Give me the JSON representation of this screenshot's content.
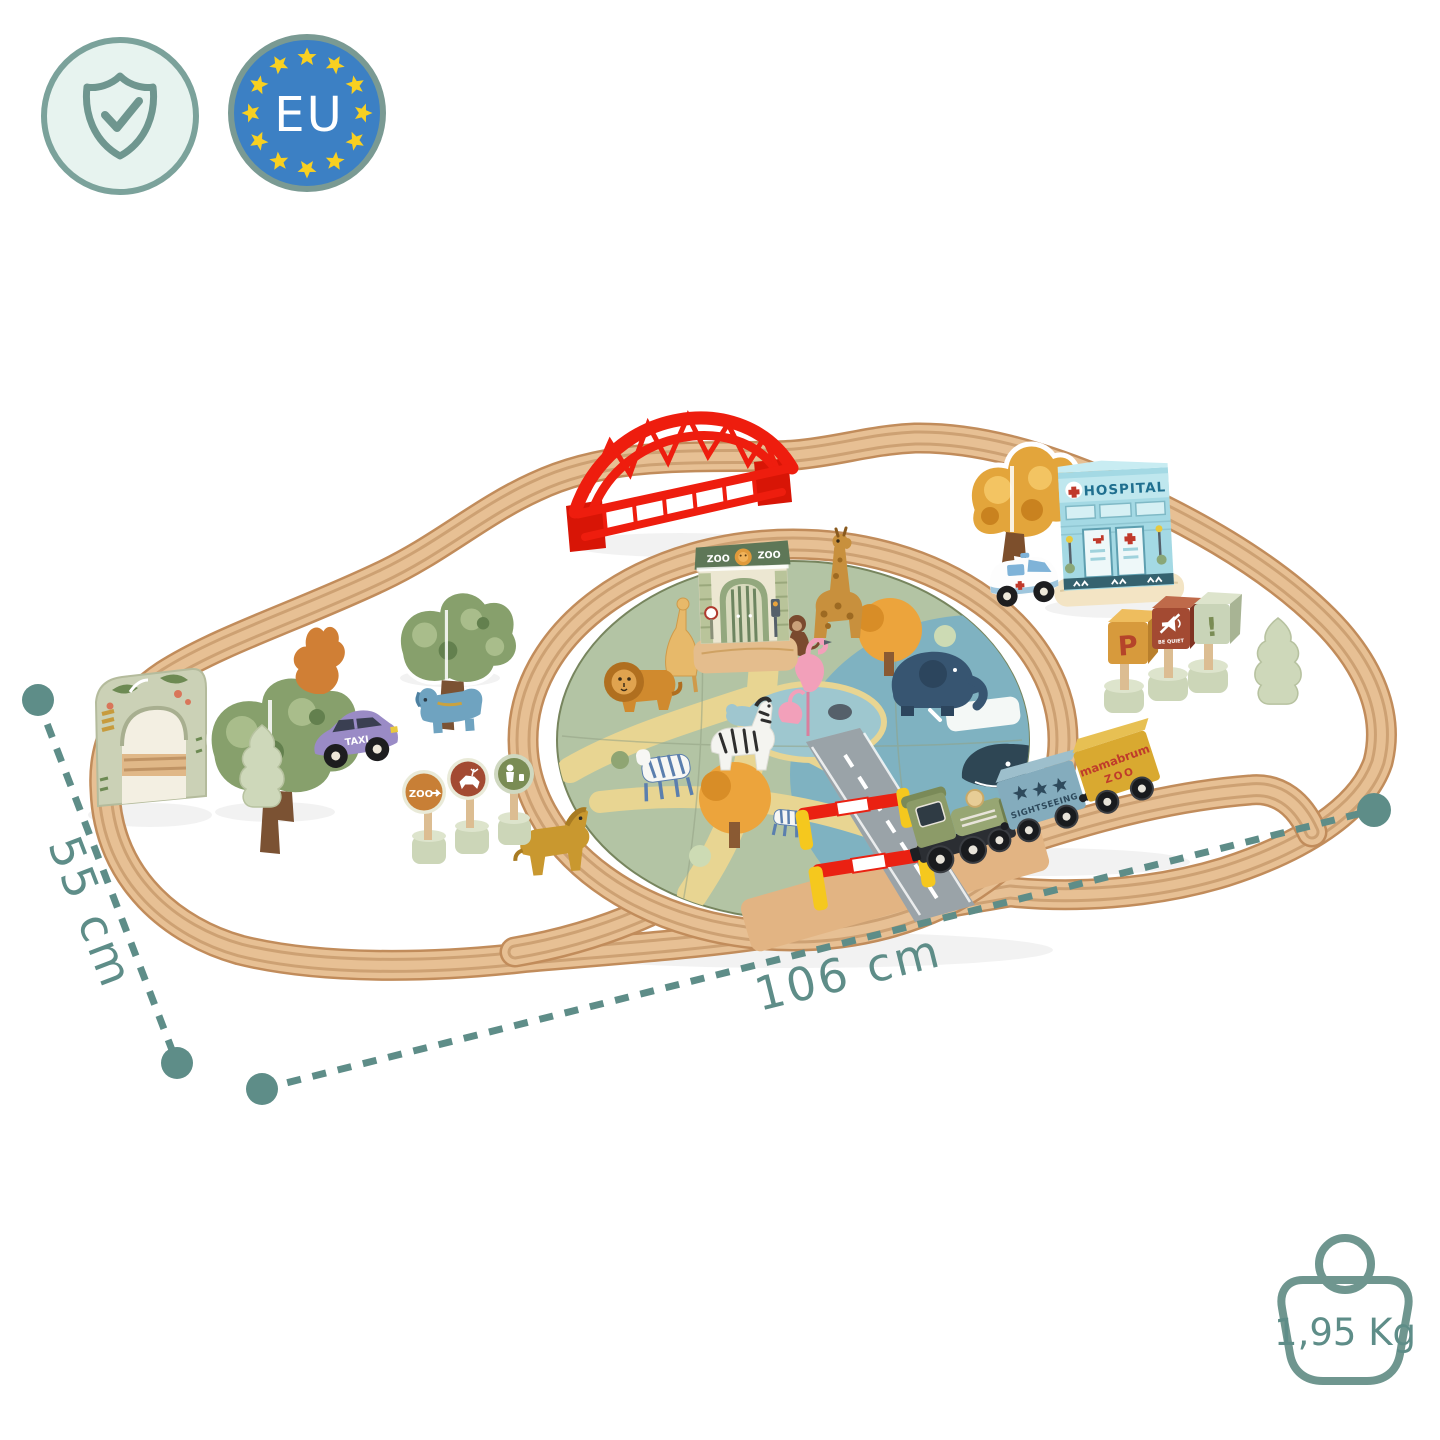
{
  "badges": {
    "quality": {
      "icon": "shield-check-icon"
    },
    "eu": {
      "label": "EU",
      "icon": "eu-stars-icon"
    }
  },
  "dimensions": {
    "depth": {
      "label": "55 cm"
    },
    "width": {
      "label": "106 cm"
    }
  },
  "weight": {
    "label": "1,95 Kg",
    "icon": "weight-icon"
  },
  "trainset": {
    "zoo_gate": {
      "left": "ZOO",
      "right": "ZOO"
    },
    "hospital": {
      "sign": "HOSPITAL"
    },
    "taxi": {
      "label": "TAXI"
    },
    "wagons": {
      "sightseeing": "SIGHTSEEING",
      "brand": "mamabrum",
      "brand_sub": "ZOO"
    },
    "signs": {
      "parking": "P",
      "quiet": "BE QUIET",
      "zoo_arrow": "ZOO",
      "warning": "!"
    }
  },
  "colors": {
    "accent_teal": "#5E8D88",
    "eu_blue": "#3C80C4",
    "star_yellow": "#F8D021",
    "wood": "#E7C094",
    "bridge_red": "#EE1D0E",
    "mat_green": "#B3C4A4",
    "sea_blue": "#7FB2C1",
    "loco_green": "#8C9B68",
    "wagon_blue": "#84ACBD",
    "wagon_yellow": "#D9A930",
    "taxi_purple": "#9A8BC6",
    "hospital_blue": "#A8DCE6"
  }
}
